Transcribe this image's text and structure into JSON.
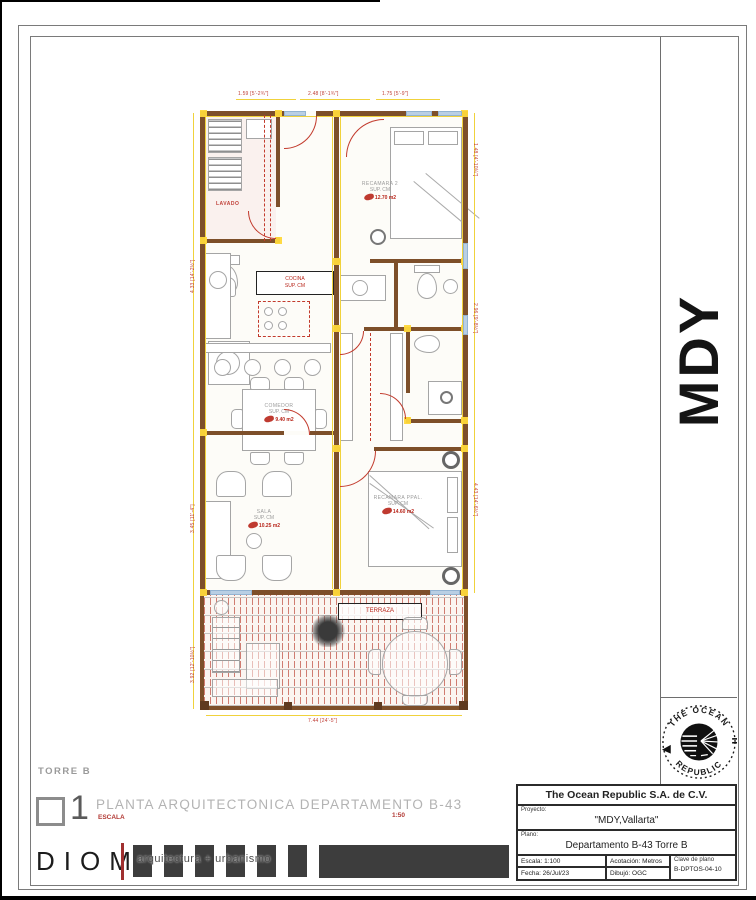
{
  "side": {
    "code": "MDY"
  },
  "logo": {
    "arc_top": "THE OCEAN",
    "arc_bottom": "REPUBLIC"
  },
  "footer": {
    "torre": "TORRE B",
    "number": "1",
    "title": "PLANTA ARQUITECTONICA DEPARTAMENTO B-43",
    "escala_label": "ESCALA",
    "escala_value": "1:50",
    "diom": "DIOM",
    "tagline": "arquitectura + urbanismo"
  },
  "titleblock": {
    "company": "The Ocean Republic S.A. de C.V.",
    "proyecto_label": "Proyecto:",
    "proyecto": "\"MDY,Vallarta\"",
    "plano_label": "Plano:",
    "plano": "Departamento B-43 Torre B",
    "escala": "Escala: 1:100",
    "acotacion": "Acotación: Metros",
    "clave_label": "Clave de plano",
    "clave": "B-DPTOS-04-10",
    "fecha": "Fecha: 26/Jul/23",
    "dibujo": "Dibujó: OGC"
  },
  "plan": {
    "rooms": {
      "lavado": "LAVADO",
      "recamara2": {
        "name": "RECAMARA 2",
        "sup": "SUP. CM",
        "area": "12.70 m2"
      },
      "comedor": {
        "name": "COMEDOR",
        "sup": "SUP. CM",
        "area": "9.40 m2"
      },
      "sala": {
        "name": "SALA",
        "sup": "SUP. CM",
        "area": "10.25 m2"
      },
      "ppal": {
        "name": "RECAMARA PPAL.",
        "sup": "SUP. CM",
        "area": "14.60 m2"
      }
    },
    "kitchen_note": {
      "line1": "COCINA",
      "line2": "SUP. CM"
    },
    "terraza_label": "TERRAZA",
    "dims": {
      "top": [
        "1.59 [5'-2¾\"]",
        "2.48 [8'-1¾\"]",
        "1.75 [5'-9\"]"
      ],
      "left": [
        "4.33 [14'-2½\"]",
        "3.45 [11'-4\"]",
        "3.92 [12'-10½\"]"
      ],
      "right": [
        "1.48 [4'-10¼\"]",
        "2.96 [9'-8½\"]",
        "4.43 [14'-6½\"]"
      ],
      "bottom": "7.44 [24'-5\"]"
    },
    "colors": {
      "wall": "#7d4f2a",
      "dim_yellow": "#f0d23c",
      "annot_red": "#c0392b",
      "window_blue": "#b9cfe4"
    }
  }
}
